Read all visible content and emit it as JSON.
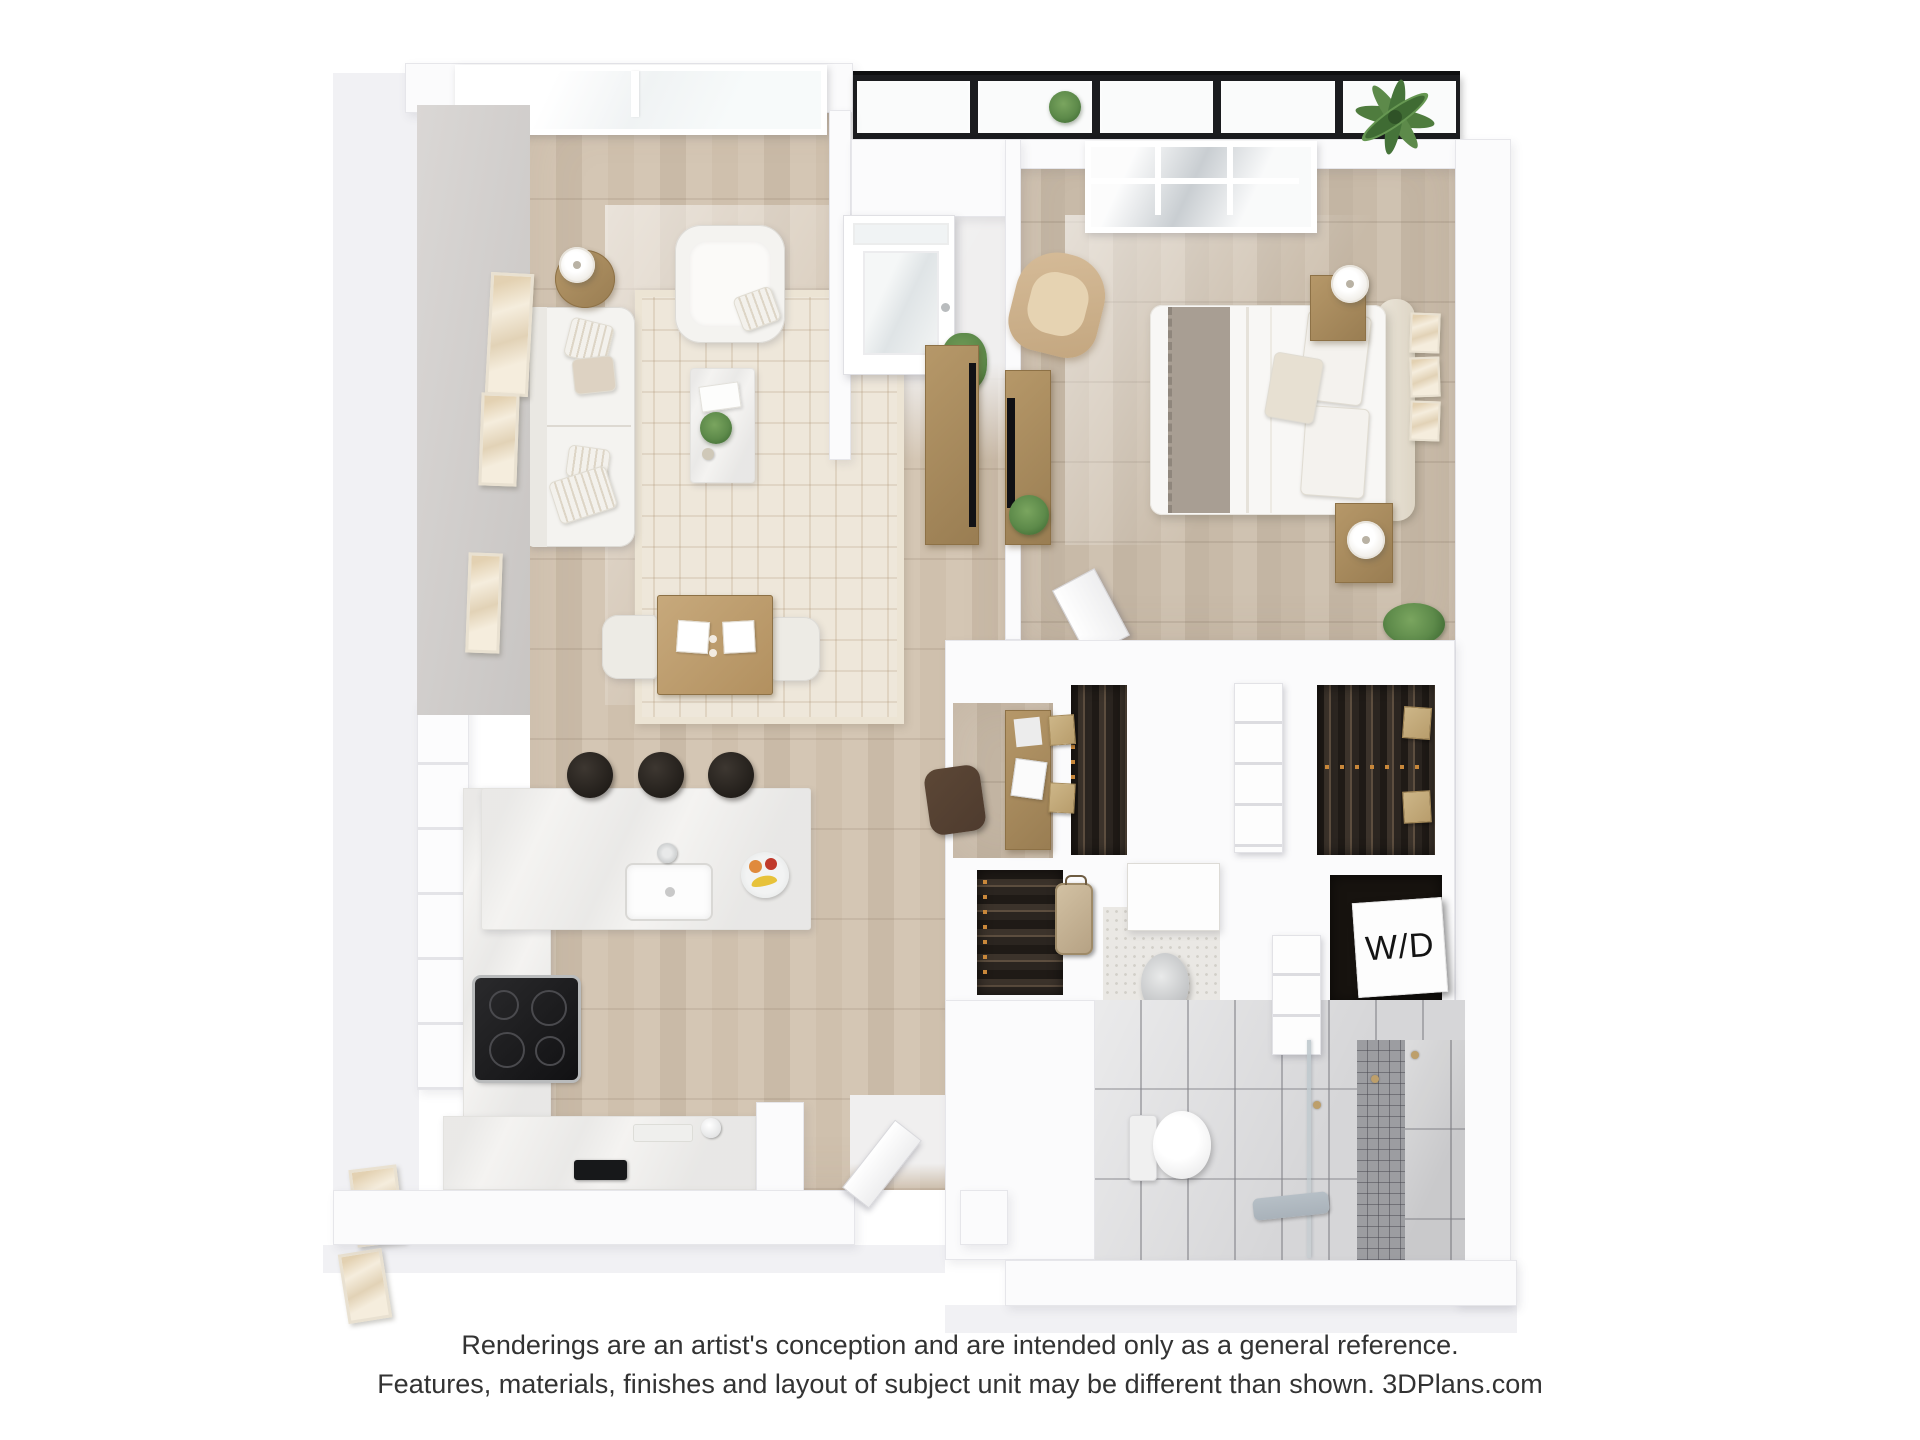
{
  "labels": {
    "washer_dryer": "W/D"
  },
  "footer": {
    "line1": "Renderings are an artist's conception and are intended only as a general reference.",
    "line2": "Features, materials, finishes and layout of subject unit may be different than shown. 3DPlans.com"
  },
  "branding": {
    "site": "3DPlans.com"
  },
  "colors": {
    "page_bg": "#ffffff",
    "text": "#333333",
    "ext": "#f1f1f4",
    "wall": "#fbfbfc",
    "wall_edge": "#e6e6ea",
    "gray_face_a": "#dad7d5",
    "gray_face_b": "#c8c5c3",
    "wood_a": "#d4c6b4",
    "wood_b": "#c9baa7",
    "wood_line": "#b4a28c",
    "wood_bed_a": "#cfc2b1",
    "wood_bed_b": "#c3b5a3",
    "closet_bg": "#2b2520",
    "closet_dark": "#1f1a16",
    "closet_mid": "#5d4e3f",
    "hanger": "#c8873a",
    "marble": "#f4f3f1",
    "marble_vein": "#d8d6d2",
    "tile": "#d6d6d8",
    "tile_line": "#aeaeb2",
    "mosaic": "#9c9da1",
    "mosaic_line": "#6e6e74",
    "terrazzo": "#eae8e4",
    "terrazzo_dot": "#d2cfc8",
    "band_dark": "#1b1c1f",
    "glass": "#f0f3f4",
    "glass_bed": "#e8ebed",
    "white_furn": "#f4f3f0",
    "furn_shadow": "#dddbd6",
    "tan": "#d6bc99",
    "tan_light": "#e6d3b2",
    "wood_furn": "#b69869",
    "wood_furn_dark": "#997d52",
    "stool_a": "#3d3731",
    "stool_b": "#211d19",
    "plant_a": "#5d8a4a",
    "plant_b": "#3f6b33",
    "rug_bg": "#eee7da",
    "rug_line": "#c3ab8d",
    "throw": "#a89e93",
    "leather": "#4e3b2e",
    "towel": "#a9b2ba",
    "gold": "#bd9f6b",
    "steel": "#c7c9ca",
    "wd_bg": "#fdfdfd",
    "wd_text": "#141414"
  }
}
